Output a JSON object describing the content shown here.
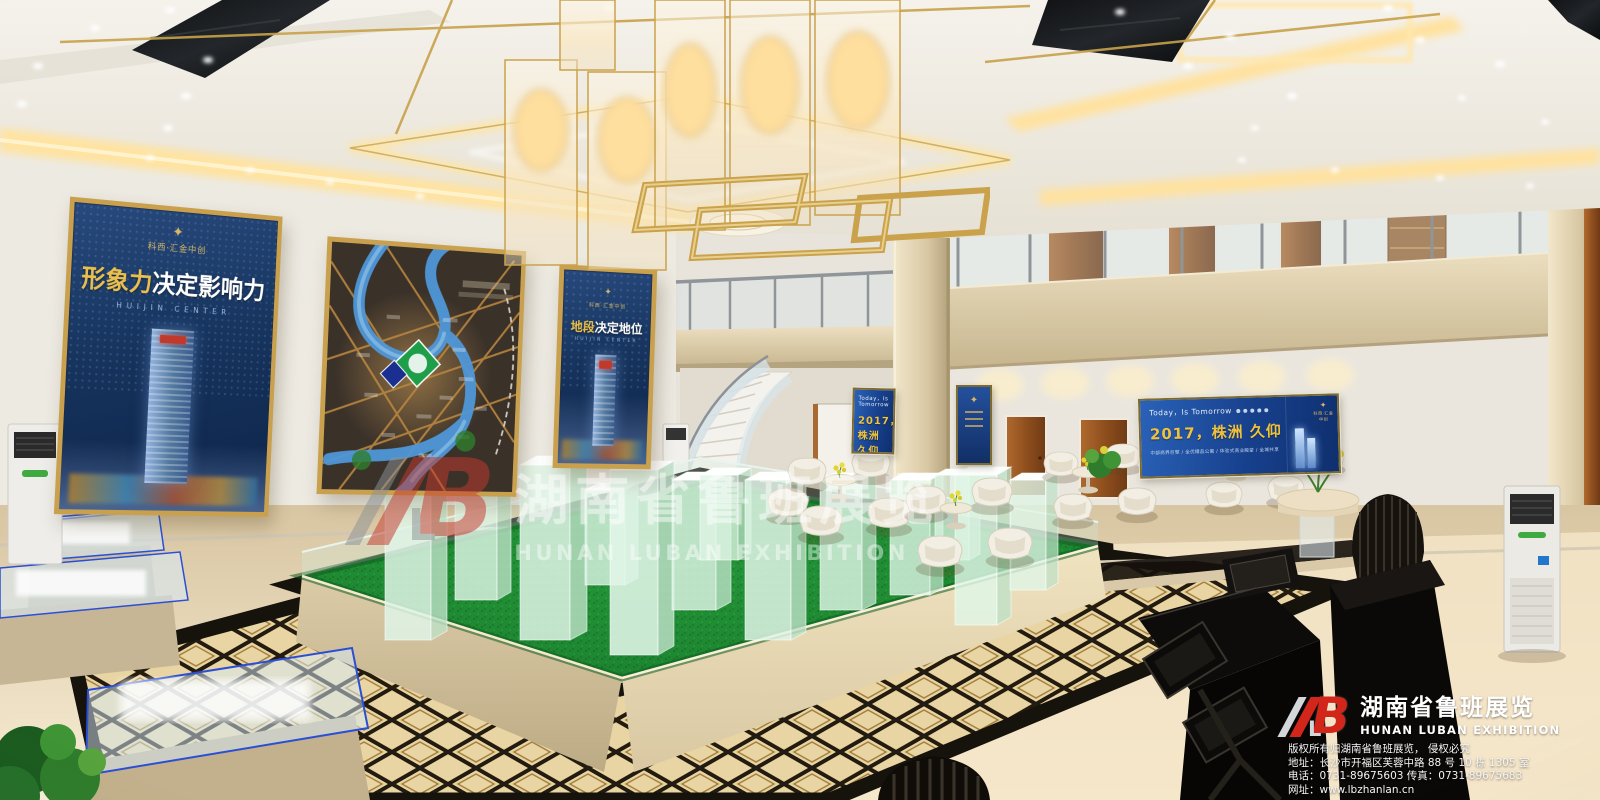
{
  "posters": {
    "left": {
      "logo_text": "科西·汇金中创",
      "title_highlight": "形象力",
      "title_rest": "决定影响力",
      "subtitle": "HUIJIN CENTER"
    },
    "right": {
      "logo_text": "科西·汇金中创",
      "title_highlight": "地段",
      "title_rest": "决定地位",
      "subtitle": "HUIJIN CENTER"
    }
  },
  "screens": {
    "tagline": "Today，Is Tomorrow",
    "headline": "2017，株洲 久仰",
    "subline": "中部商界巨擘 / 全优精品公寓 / 体验式商业殿堂 / 全城共享",
    "logo_text": "科西·汇金中创"
  },
  "watermark": {
    "logo_letter_b": "B",
    "logo_letter_l": "L",
    "company_cn": "湖南省鲁班展览",
    "company_en": "HUNAN LUBAN EXHIBITION"
  },
  "footer": {
    "logo_letter_b": "B",
    "logo_letter_l": "L",
    "company_cn": "湖南省鲁班展览",
    "company_en": "HUNAN LUBAN EXHIBITION",
    "copyright": "版权所有归湖南省鲁班展览， 侵权必究",
    "address": "地址：长沙市开福区芙蓉中路 88 号 10 栋 1305 室",
    "phone_fax": "电话：0731-89675603   传真：0731-89675683",
    "website": "网址：www.lbzhanlan.cn"
  },
  "colors": {
    "gold": "#c9a24b",
    "navy": "#12315c",
    "screen_blue": "#1a4a94",
    "grass": "#1f8c33",
    "brand_red": "#d2261a"
  }
}
